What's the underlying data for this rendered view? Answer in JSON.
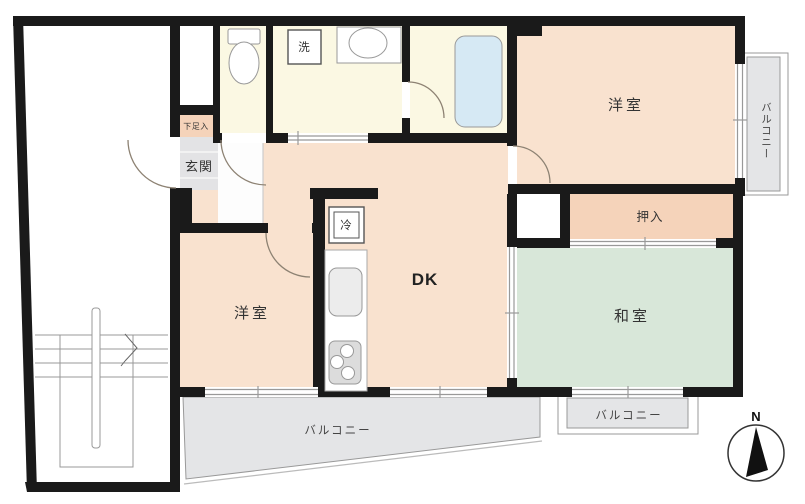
{
  "labels": {
    "room_top_right": "洋室",
    "room_left": "洋室",
    "dk": "DK",
    "washitsu": "和室",
    "oshiire": "押入",
    "genkan": "玄関",
    "shoe_cabinet": "下足入",
    "washer": "洗",
    "fridge": "冷",
    "balcony_right": "バルコニー",
    "balcony_bottom": "バルコニー",
    "balcony_bottom_right": "バルコニー",
    "compass_north": "N"
  },
  "colors": {
    "wall": "#1a1a1a",
    "room_peach": "#f9e2cf",
    "closet_peach": "#f5d3ba",
    "wet_cream": "#fbf8e3",
    "tatami_green": "#d8e7d9",
    "balcony_gray": "#e4e5e7",
    "bath_blue": "#d6e9f4",
    "genkan_gray": "#e3e3e5",
    "line_gray": "#999999",
    "fixture_gray": "#aaaaaa",
    "door_arc": "#8d8273",
    "needle_black": "#111111"
  }
}
